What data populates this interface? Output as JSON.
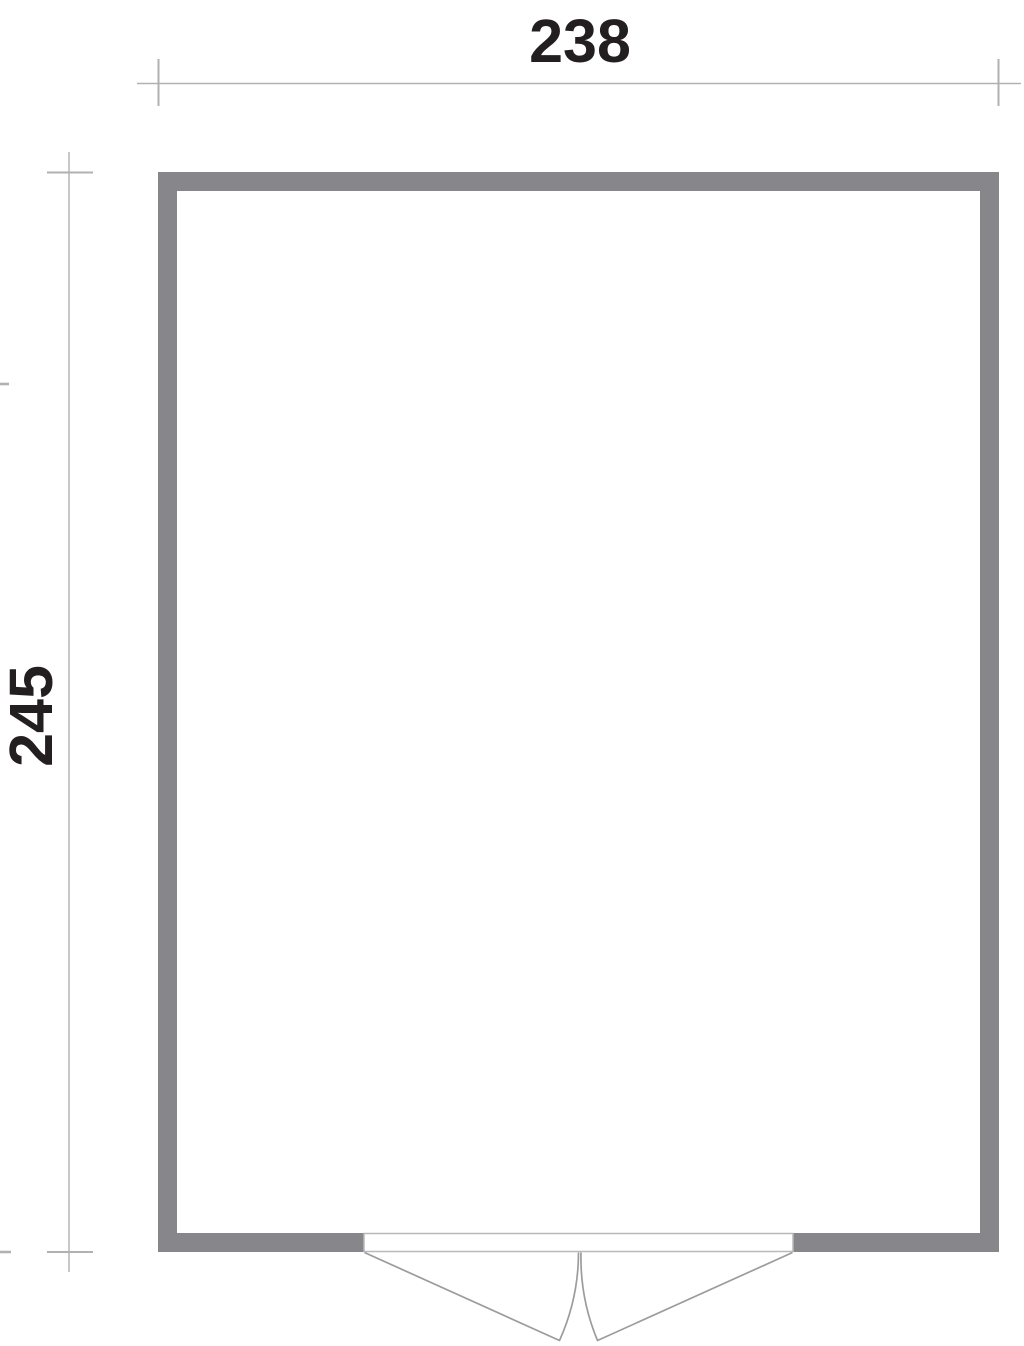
{
  "drawing": {
    "type": "floor-plan",
    "dimension_width": {
      "label": "238",
      "orientation": "horizontal",
      "position": "top"
    },
    "dimension_height": {
      "label": "245",
      "orientation": "vertical",
      "position": "left"
    },
    "door": {
      "kind": "double-swing-door",
      "position": "bottom-center",
      "swing": "outward"
    },
    "colors": {
      "background": "#ffffff",
      "wall_fill": "#87878b",
      "dimension_line": "#b1b1b3",
      "label_text": "#231f20",
      "door_line": "#9c9c9e",
      "threshold_border": "#b9b9bb",
      "floor_fill": "#ffffff"
    }
  }
}
